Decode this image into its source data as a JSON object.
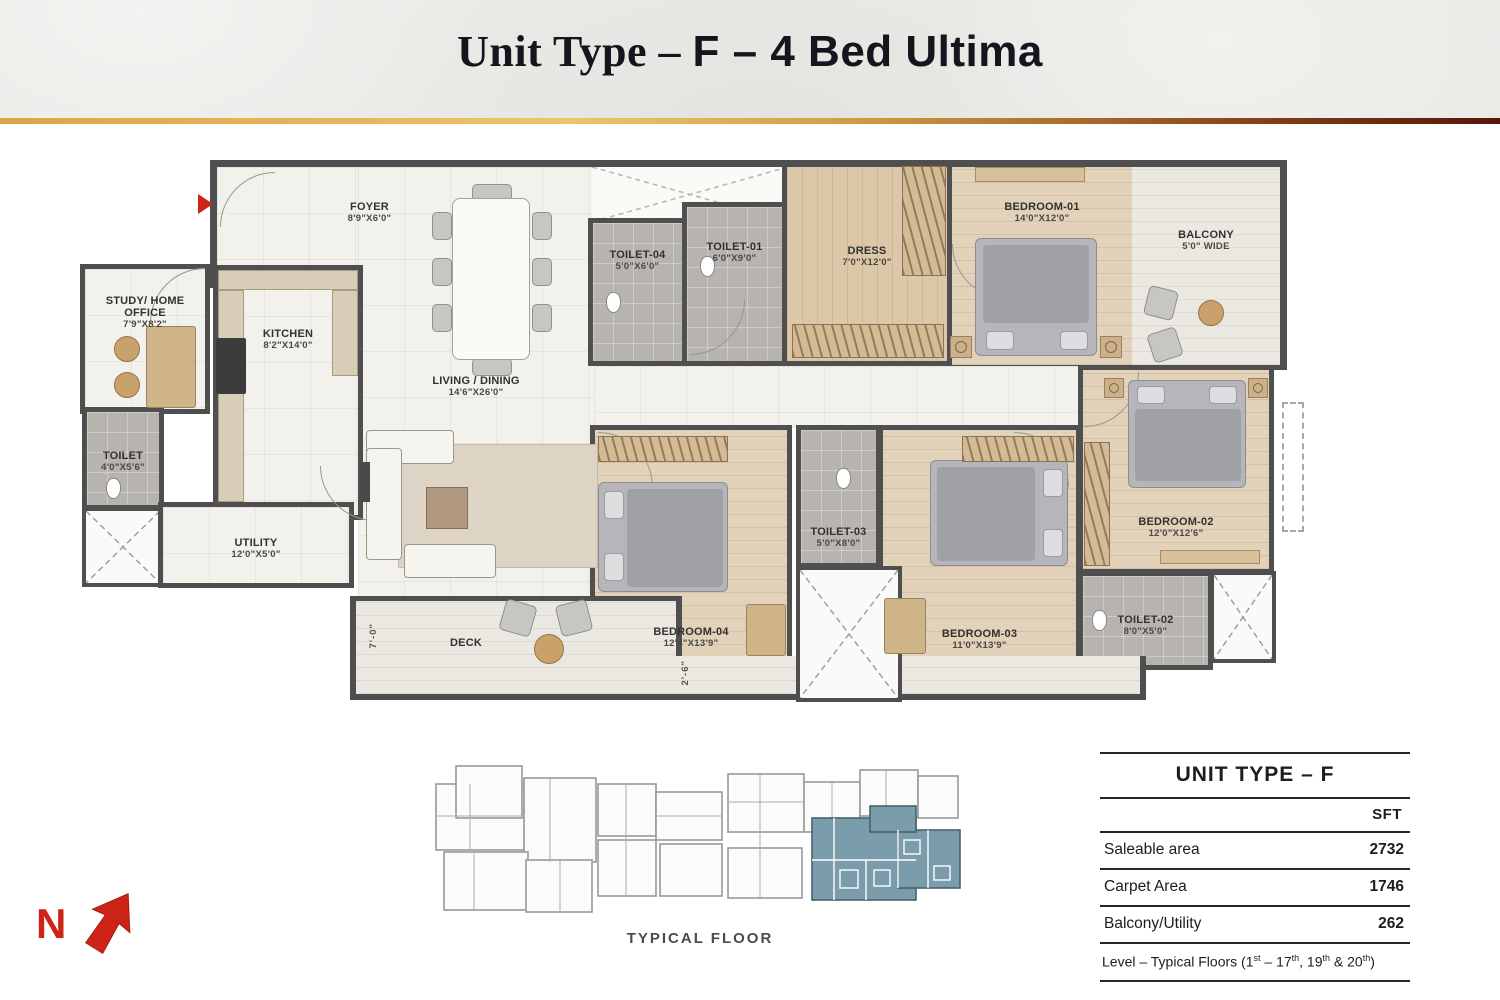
{
  "title": {
    "serif": "Unit Type – ",
    "sans": "F – 4 Bed Ultima"
  },
  "plan": {
    "rooms": {
      "foyer": {
        "name": "FOYER",
        "dim": "8'9\"X6'0\""
      },
      "study": {
        "name": "STUDY/ HOME OFFICE",
        "dim": "7'9\"X8'2\""
      },
      "toilet_st": {
        "name": "TOILET",
        "dim": "4'0\"X5'6\""
      },
      "kitchen": {
        "name": "KITCHEN",
        "dim": "8'2\"X14'0\""
      },
      "living": {
        "name": "LIVING / DINING",
        "dim": "14'6\"X26'0\""
      },
      "utility": {
        "name": "UTILITY",
        "dim": "12'0\"X5'0\""
      },
      "deck": {
        "name": "DECK"
      },
      "toilet04": {
        "name": "TOILET-04",
        "dim": "5'0\"X6'0\""
      },
      "toilet01": {
        "name": "TOILET-01",
        "dim": "6'0\"X9'0\""
      },
      "dress": {
        "name": "DRESS",
        "dim": "7'0\"X12'0\""
      },
      "bedroom01": {
        "name": "BEDROOM-01",
        "dim": "14'0\"X12'0\""
      },
      "balcony": {
        "name": "BALCONY",
        "dim": "5'0\" WIDE"
      },
      "bedroom02": {
        "name": "BEDROOM-02",
        "dim": "12'0\"X12'6\""
      },
      "toilet02": {
        "name": "TOILET-02",
        "dim": "8'0\"X5'0\""
      },
      "bedroom03": {
        "name": "BEDROOM-03",
        "dim": "11'0\"X13'9\""
      },
      "toilet03": {
        "name": "TOILET-03",
        "dim": "5'0\"X8'0\""
      },
      "bedroom04": {
        "name": "BEDROOM-04",
        "dim": "12'4\"X13'9\""
      }
    },
    "dims": {
      "deck_width": "7'-0\"",
      "deck_strip": "2'-6\""
    }
  },
  "north": {
    "label": "N"
  },
  "keyplan": {
    "caption": "TYPICAL FLOOR"
  },
  "area_table": {
    "title": "UNIT TYPE – F",
    "unit_header": "SFT",
    "rows": [
      {
        "label": "Saleable area",
        "value": "2732"
      },
      {
        "label": "Carpet Area",
        "value": "1746"
      },
      {
        "label": "Balcony/Utility",
        "value": "262"
      }
    ],
    "footer_parts": [
      "Level – Typical Floors (1",
      "st",
      " – 17",
      "th",
      ", 19",
      "th",
      " & 20",
      "th",
      ")"
    ]
  },
  "colors": {
    "accent_gold": "#d9a845",
    "accent_maroon": "#551708",
    "highlight_teal": "#7b9cab",
    "north_red": "#ce2418",
    "wall": "#4f4f4f"
  }
}
